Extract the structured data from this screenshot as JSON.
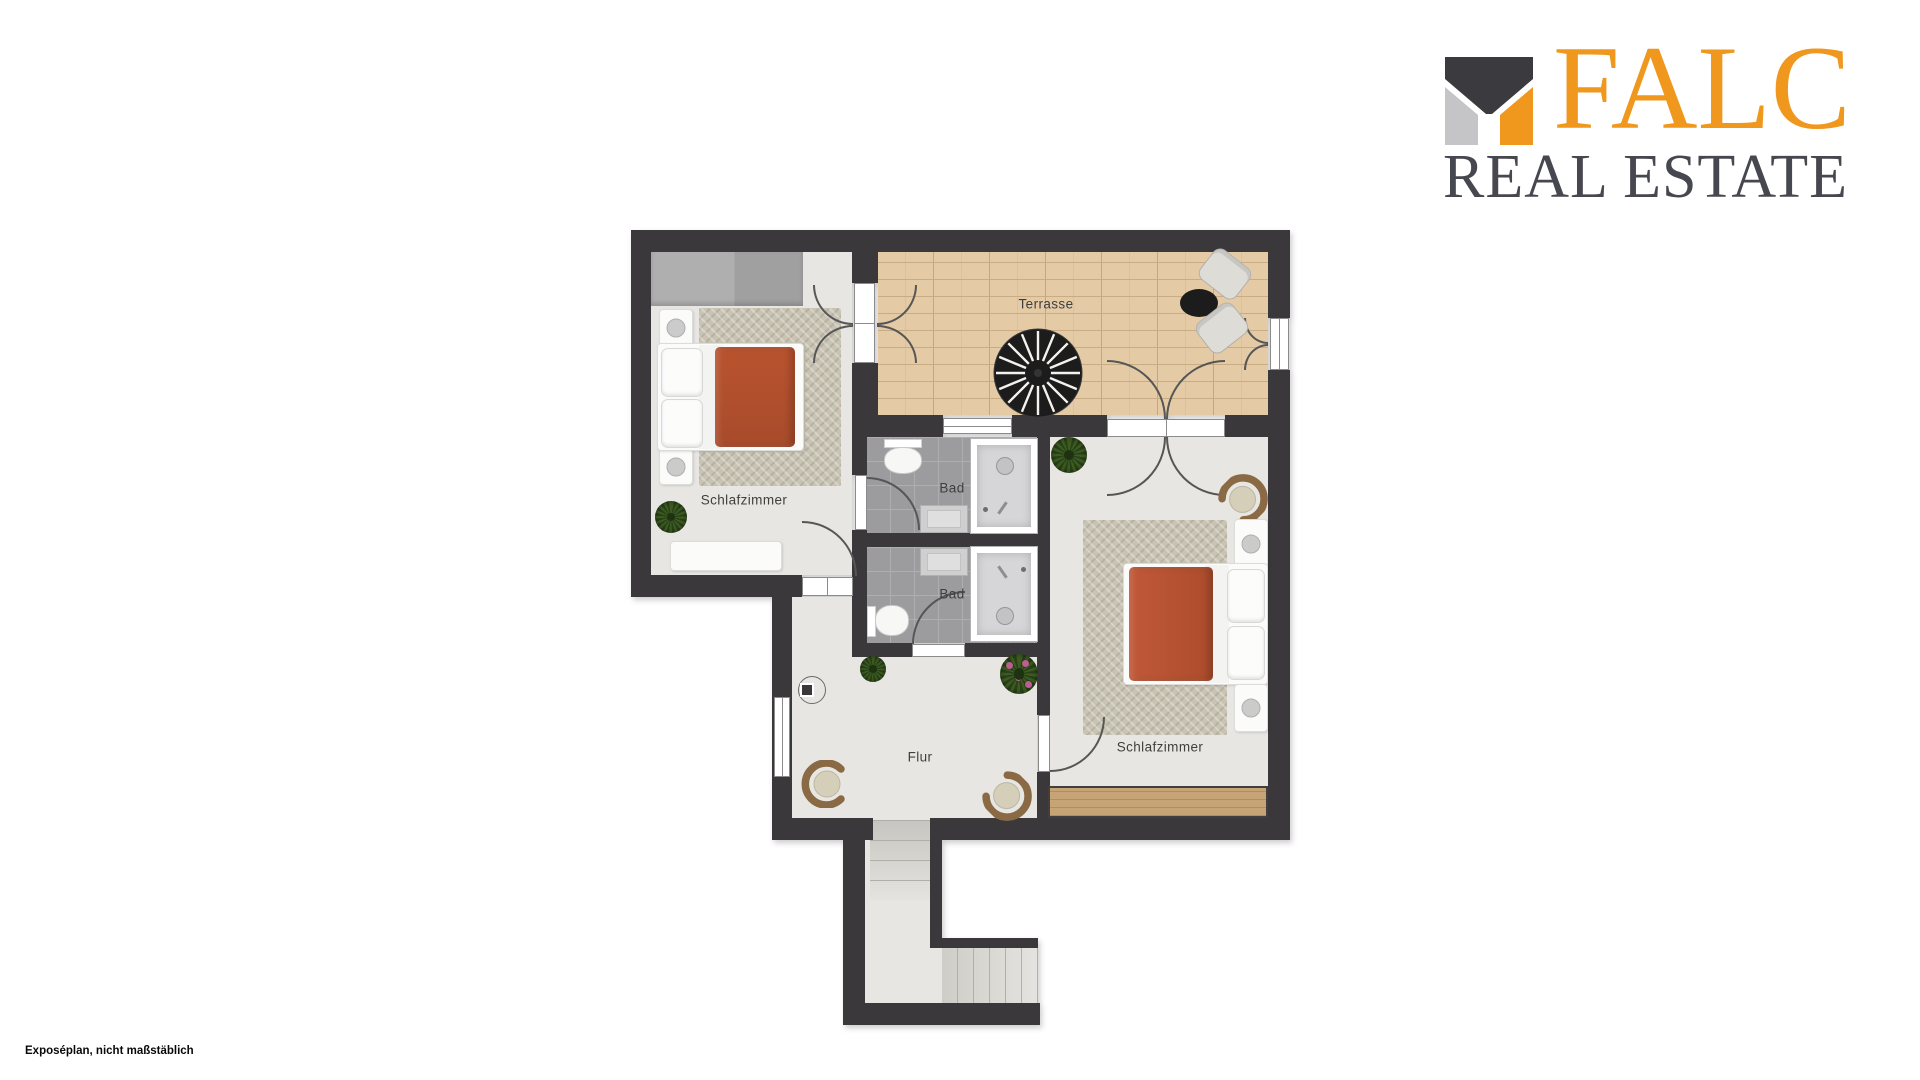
{
  "logo": {
    "title": "FALC",
    "subtitle": "REAL ESTATE"
  },
  "footer": {
    "note": "Exposéplan, nicht maßstäblich"
  },
  "floorplan": {
    "rooms": [
      {
        "id": "schlafzimmer-1",
        "label": "Schlafzimmer"
      },
      {
        "id": "terrasse",
        "label": "Terrasse"
      },
      {
        "id": "bad-1",
        "label": "Bad"
      },
      {
        "id": "bad-2",
        "label": "Bad"
      },
      {
        "id": "flur",
        "label": "Flur"
      },
      {
        "id": "schlafzimmer-2",
        "label": "Schlafzimmer"
      }
    ]
  },
  "colors": {
    "wall": "#3a383a",
    "floor": "#e7e6e2",
    "terrace-floor": "#e4cba6",
    "terrace-joint": "#c9ab84",
    "bath-floor": "#9c9c9e",
    "bath-grid": "#aeaeb0",
    "rug": "#c8c3b3",
    "duvet": "#b9532f",
    "wood": "#c6a476",
    "wardrobe": "#a8a8a8",
    "label-text": "#3f3f3f",
    "logo-orange": "#f0971d",
    "logo-gray": "#c5c5c7",
    "logo-dark": "#3b3a3e",
    "logo-subtitle": "#47474f"
  }
}
